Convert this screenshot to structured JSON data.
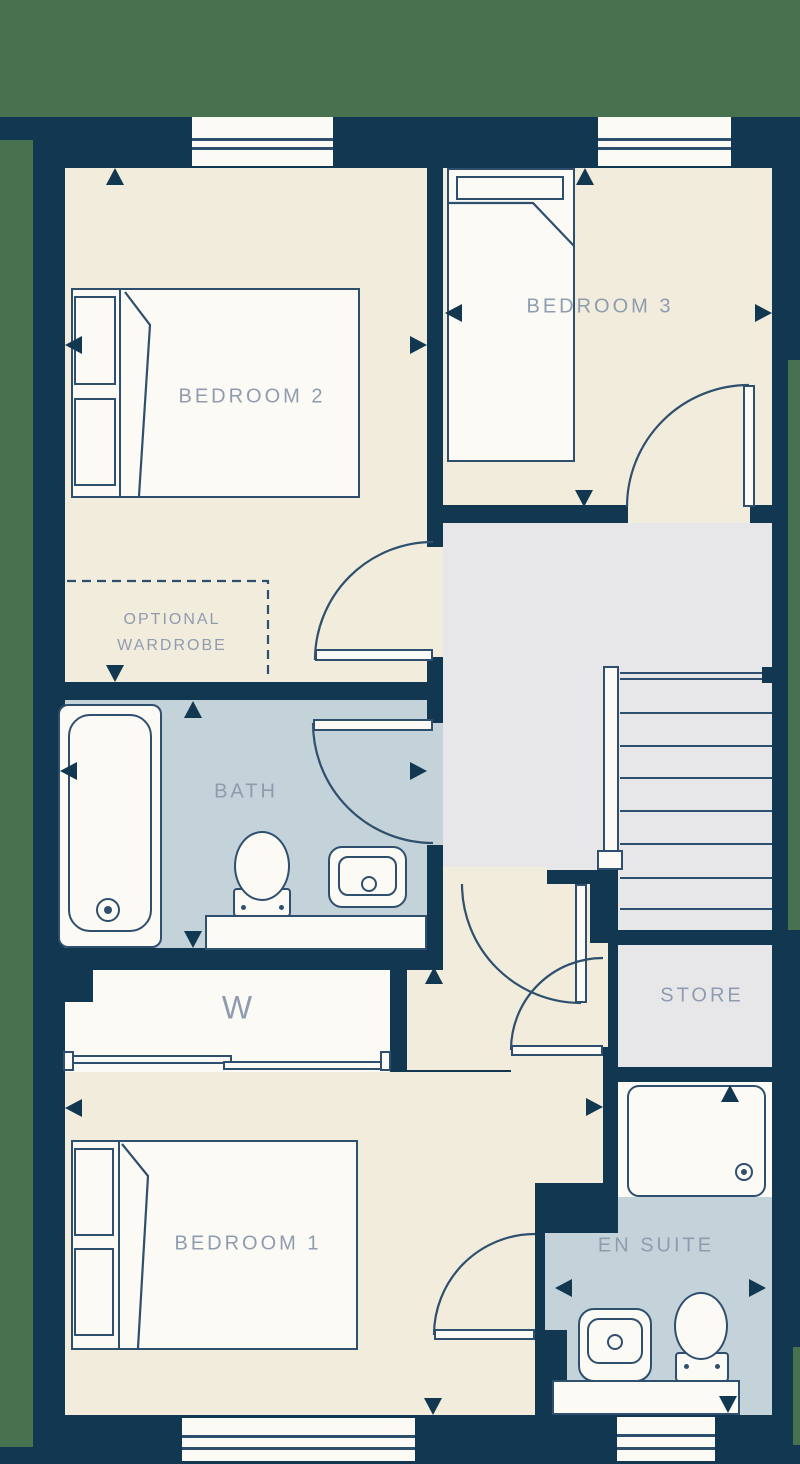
{
  "floorplan": {
    "rooms": {
      "bedroom2": {
        "label": "BEDROOM 2"
      },
      "bedroom3": {
        "label": "BEDROOM 3"
      },
      "bedroom1": {
        "label": "BEDROOM 1"
      },
      "bath": {
        "label": "BATH"
      },
      "store": {
        "label": "STORE"
      },
      "ensuite": {
        "label": "EN SUITE"
      },
      "wardrobe": {
        "label": "W"
      },
      "optional_wardrobe": {
        "label_line1": "OPTIONAL",
        "label_line2": "WARDROBE"
      }
    },
    "colors": {
      "wall": "#113850",
      "outside": "#47714f",
      "floor_cream": "#f1ecdc",
      "floor_light": "#fbfaf5",
      "floor_gray": "#e7e7ea",
      "floor_blue": "#c4d2d9",
      "line": "#2f4f6e",
      "label": "#8f9cb0"
    }
  }
}
